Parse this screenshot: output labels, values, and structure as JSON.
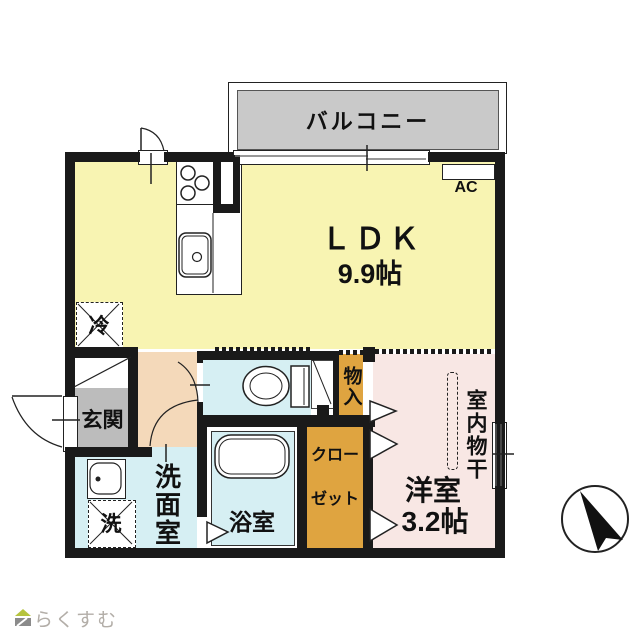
{
  "plan": {
    "balcony_label": "バルコニー",
    "ldk_label": "ＬＤＫ",
    "ldk_size": "9.9帖",
    "ac_label": "AC",
    "fridge_label": "冷",
    "entrance_label": "玄関",
    "washer_label": "洗",
    "washroom_label": "洗面室",
    "bath_label": "浴室",
    "storage_label": "物入",
    "closet_line1": "クロー",
    "closet_line2": "ゼット",
    "western_room_label": "洋室",
    "western_room_size": "3.2帖",
    "indoor_drying_label": "室内物干"
  },
  "footer": {
    "logo_text": "らくすむ"
  },
  "colors": {
    "ldk_yellow": "#f8f4b2",
    "hall_peach": "#f4d9ba",
    "wet_blue": "#d6eff3",
    "storage_orange": "#dfa440",
    "room_pink": "#f8e7e4",
    "balcony_gray": "#c9c9c9",
    "entrance_gray": "#bcbcbc",
    "wall_black": "#1a1a1a"
  }
}
